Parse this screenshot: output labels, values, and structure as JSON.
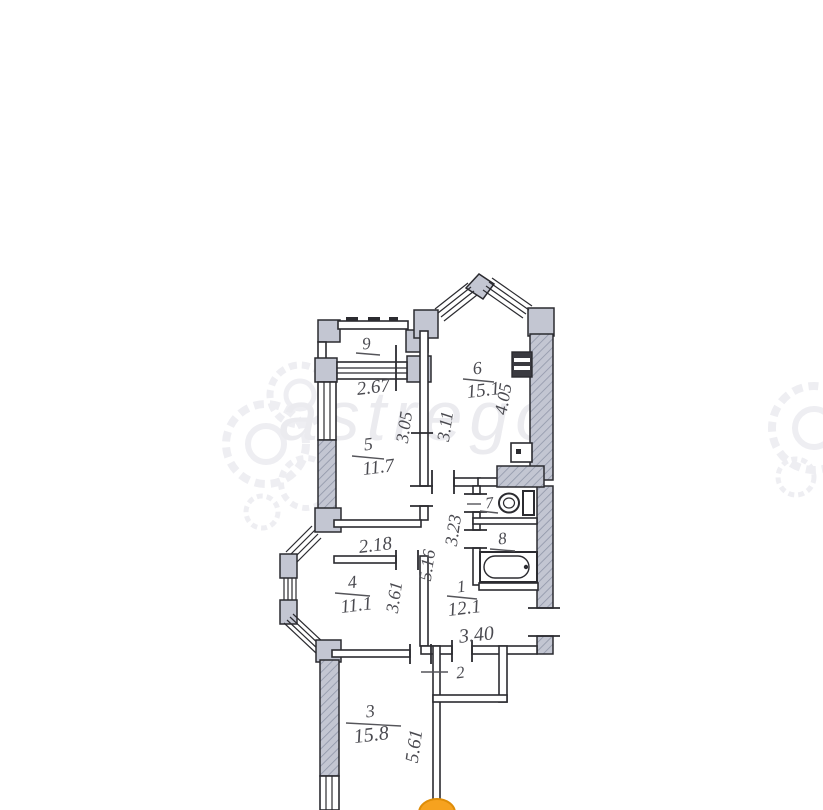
{
  "title": "apartment-floor-plan",
  "colors": {
    "background": "#ffffff",
    "wall_fill": "#c3c6d2",
    "outline": "#2b2b30",
    "label": "#4a4a50",
    "pin_orange": "#f6a21f",
    "watermark": "#ebebef"
  },
  "watermark": {
    "text": "astrego"
  },
  "rooms": {
    "r1": {
      "number": "1",
      "area": "12.1"
    },
    "r2": {
      "number": "2"
    },
    "r3": {
      "number": "3",
      "area": "15.8"
    },
    "r4": {
      "number": "4",
      "area": "11.1"
    },
    "r5": {
      "number": "5",
      "area": "11.7"
    },
    "r6": {
      "number": "6",
      "area": "15.1"
    },
    "r7": {
      "number": "7"
    },
    "r8": {
      "number": "8"
    },
    "r9": {
      "number": "9"
    }
  },
  "dimensions": {
    "d267": "2.67",
    "d305": "3.05",
    "d311": "3.11",
    "d405": "4.05",
    "d218": "2.18",
    "d516": "5.16",
    "d323": "3.23",
    "d361": "3.61",
    "d340": "3.40",
    "d561": "5.61"
  }
}
